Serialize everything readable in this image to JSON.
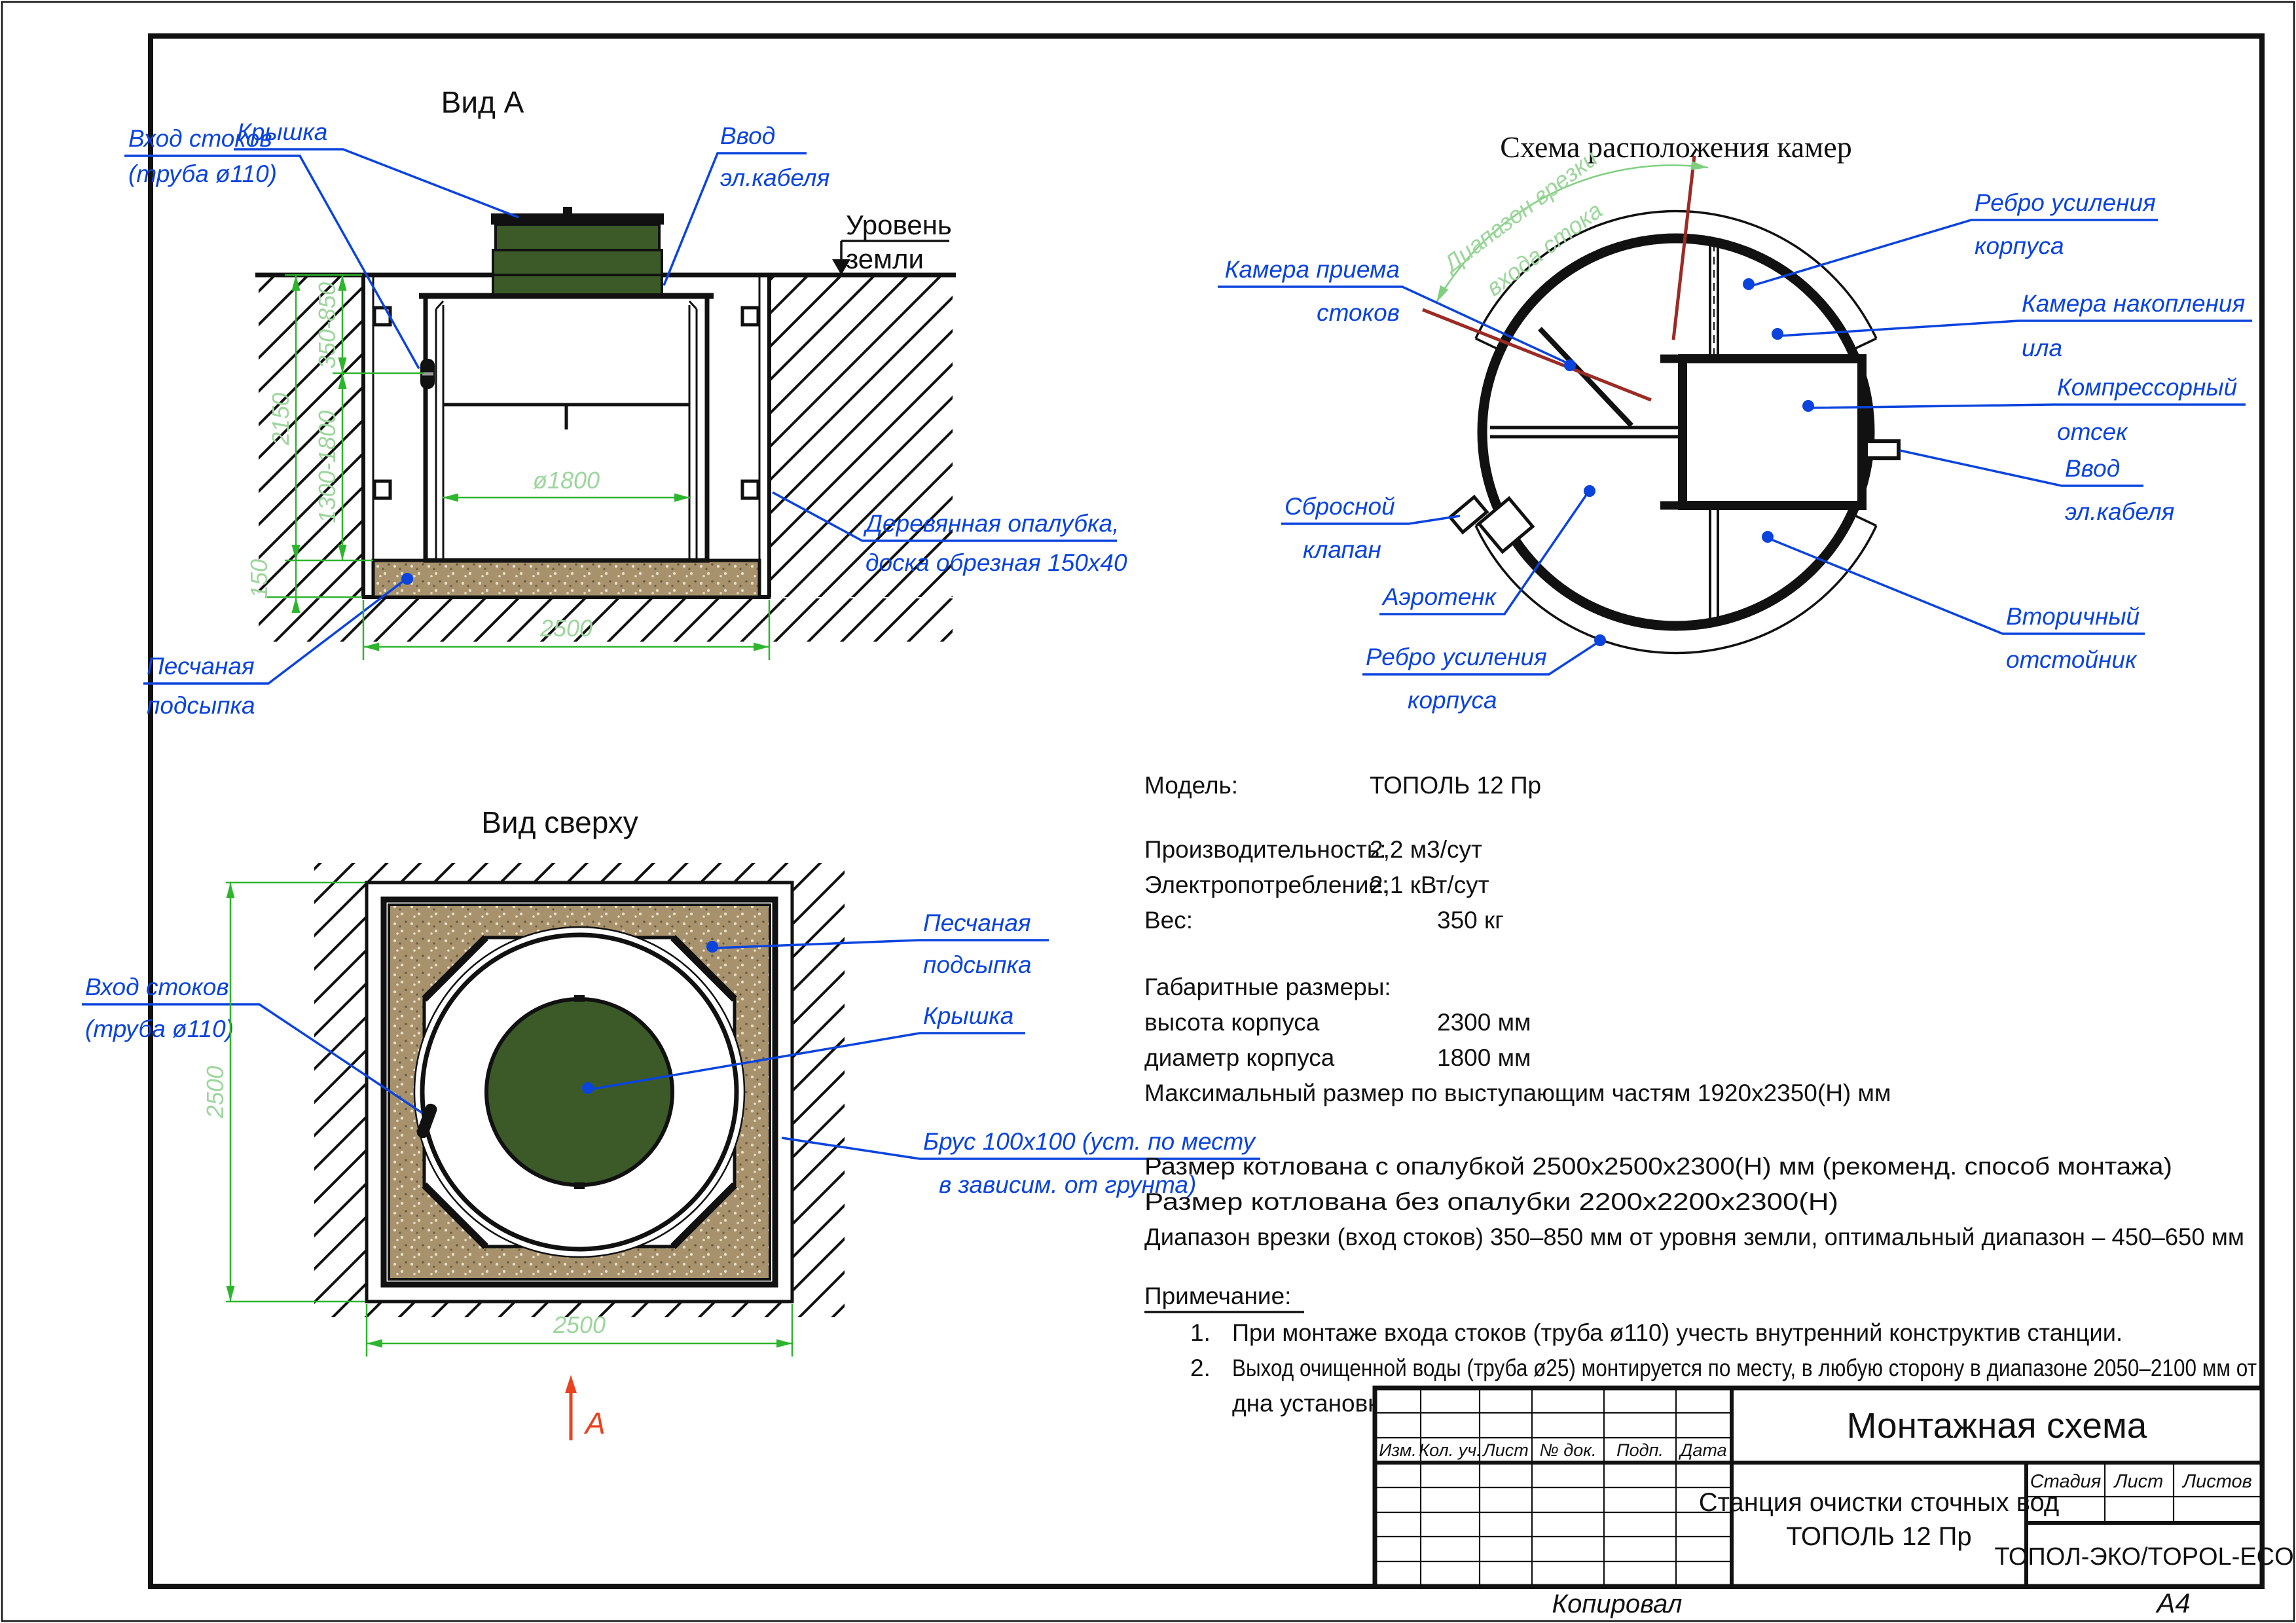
{
  "page": {
    "footer_copy": "Копировал",
    "footer_format": "А4"
  },
  "view_a": {
    "title": "Вид А",
    "labels": {
      "inlet_1": "Вход стоков",
      "inlet_2": "(труба ø110)",
      "lid": "Крышка",
      "cable_1": "Ввод",
      "cable_2": "эл.кабеля",
      "ground_1": "Уровень",
      "ground_2": "земли",
      "formwork_1": "Деревянная опалубка,",
      "formwork_2": "доска обрезная 150х40",
      "sand_1": "Песчаная",
      "sand_2": "подсыпка"
    },
    "dims": {
      "depth_total": "2150",
      "inlet_range": "350-850",
      "body_range": "1300-1800",
      "sand": "150",
      "diameter": "ø1800",
      "width": "2500"
    }
  },
  "chambers": {
    "title": "Схема расположения камер",
    "labels": {
      "intake_1": "Камера приема",
      "intake_2": "стоков",
      "rib_top_1": "Ребро усиления",
      "rib_top_2": "корпуса",
      "sludge_1": "Камера накопления",
      "sludge_2": "ила",
      "compressor_1": "Компрессорный",
      "compressor_2": "отсек",
      "cable_1": "Ввод",
      "cable_2": "эл.кабеля",
      "secondary_1": "Вторичный",
      "secondary_2": "отстойник",
      "rib_bottom_1": "Ребро усиления",
      "rib_bottom_2": "корпуса",
      "aerotank": "Аэротенк",
      "valve_1": "Сбросной",
      "valve_2": "клапан",
      "range_1": "Диапазон врезки",
      "range_2": "входа стока"
    }
  },
  "top_view": {
    "title": "Вид сверху",
    "labels": {
      "inlet_1": "Вход стоков",
      "inlet_2": "(труба ø110)",
      "sand_1": "Песчаная",
      "sand_2": "подсыпка",
      "lid": "Крышка",
      "beam_1": "Брус 100х100 (уст. по месту",
      "beam_2": "в зависим. от грунта)",
      "section_mark": "А"
    },
    "dims": {
      "width_v": "2500",
      "width_h": "2500"
    }
  },
  "specs": {
    "model_label": "Модель:",
    "model_value": "ТОПОЛЬ 12 Пр",
    "perf_label": "Производительность:",
    "perf_value": "2,2 м3/сут",
    "power_label": "Электропотребление:",
    "power_value": "2,1 кВт/сут",
    "weight_label": "Вес:",
    "weight_value": "350 кг",
    "dims_header": "Габаритные размеры:",
    "height_label": "высота корпуса",
    "height_value": "2300 мм",
    "diameter_label": "диаметр корпуса",
    "diameter_value": "1800 мм",
    "max_size": "Максимальный размер по выступающим частям 1920х2350(Н) мм",
    "pit_formwork": "Размер котлована с опалубкой 2500х2500х2300(Н) мм (рекоменд. способ монтажа)",
    "pit_plain": "Размер котлована без опалубки 2200х2200х2300(Н)",
    "inlet_range": "Диапазон врезки (вход стоков) 350–850 мм от уровня земли, оптимальный диапазон – 450–650 мм"
  },
  "notes": {
    "header": "Примечание:",
    "n1_num": "1.",
    "n1": "При монтаже входа  стоков (труба  ø110) учесть внутренний конструктив станции.",
    "n2_num": "2.",
    "n2a": "Выход очищенной воды (труба ø25) монтируется по месту, в любую сторону в диапазоне 2050–2100 мм от",
    "n2b": "дна установки до нижнего края трубы."
  },
  "title_block": {
    "col_izm": "Изм.",
    "col_kol": "Кол. уч.",
    "col_list": "Лист",
    "col_doc": "№ док.",
    "col_podp": "Подп.",
    "col_data": "Дата",
    "scheme_title": "Монтажная схема",
    "doc_name_1": "Станция очистки сточных вод",
    "doc_name_2": "ТОПОЛЬ 12 Пр",
    "stage": "Стадия",
    "sheet": "Лист",
    "sheets": "Листов",
    "company": "ТОПОЛ-ЭКО/TOPOL-ECO"
  },
  "colors": {
    "label_blue": "#0b44dd",
    "dim_green": "#2eb52e",
    "dim_text_green": "#9cd69c",
    "lid_green": "#3b5a28",
    "sand_tan": "#a7926d",
    "section_red": "#e8431e",
    "range_dark_red": "#9b2b24"
  }
}
